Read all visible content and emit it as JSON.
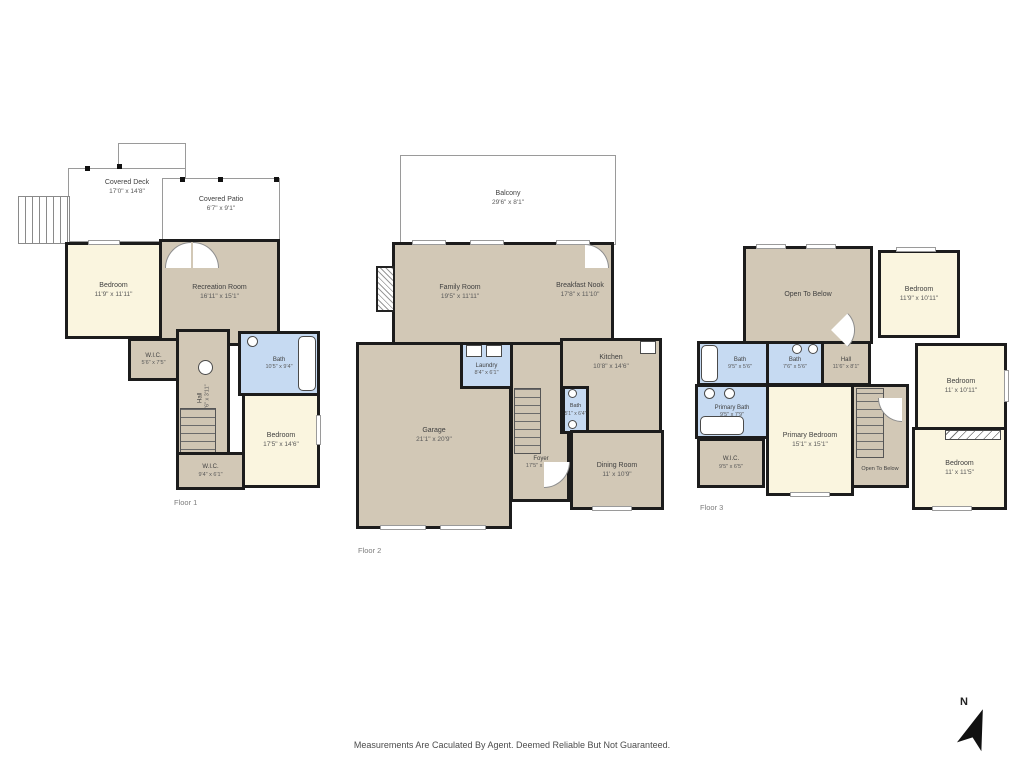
{
  "page": {
    "disclaimer": "Measurements Are Caculated By Agent. Deemed Reliable But Not Guaranteed.",
    "compass_label": "N"
  },
  "colors": {
    "wall": "#1c1c1c",
    "room_tan": "#d2c8b6",
    "room_cream": "#faf5df",
    "room_blue": "#c6daf2",
    "outdoor_outline": "#9a9a9a"
  },
  "floors": [
    {
      "label": "Floor 1",
      "rooms": [
        {
          "name": "Covered Deck",
          "dims": "17'0\" x 14'8\""
        },
        {
          "name": "Covered Patio",
          "dims": "6'7\" x 9'1\""
        },
        {
          "name": "Bedroom",
          "dims": "11'9\" x 11'11\""
        },
        {
          "name": "Recreation Room",
          "dims": "16'11\" x 15'1\""
        },
        {
          "name": "W.I.C.",
          "dims": "5'6\" x 7'5\""
        },
        {
          "name": "Bath",
          "dims": "10'5\" x 9'4\""
        },
        {
          "name": "Hall",
          "dims": "9'6\" x 3'11\""
        },
        {
          "name": "Bedroom",
          "dims": "17'5\" x 14'6\""
        },
        {
          "name": "W.I.C.",
          "dims": "9'4\" x 6'1\""
        }
      ]
    },
    {
      "label": "Floor 2",
      "rooms": [
        {
          "name": "Balcony",
          "dims": "29'6\" x 8'1\""
        },
        {
          "name": "Family Room",
          "dims": "19'5\" x 11'11\""
        },
        {
          "name": "Breakfast Nook",
          "dims": "17'8\" x 11'10\""
        },
        {
          "name": "Laundry",
          "dims": "8'4\" x 6'1\""
        },
        {
          "name": "Kitchen",
          "dims": "10'8\" x 14'6\""
        },
        {
          "name": "Bath",
          "dims": "5'1\" x 6'4\""
        },
        {
          "name": "Garage",
          "dims": "21'1\" x 20'9\""
        },
        {
          "name": "Foyer",
          "dims": "17'5\" x 14'6\""
        },
        {
          "name": "Dining Room",
          "dims": "11' x 10'9\""
        }
      ]
    },
    {
      "label": "Floor 3",
      "rooms": [
        {
          "name": "Open To Below",
          "dims": ""
        },
        {
          "name": "Bedroom",
          "dims": "11'9\" x 10'11\""
        },
        {
          "name": "Bath",
          "dims": "9'5\" x 5'6\""
        },
        {
          "name": "Bath",
          "dims": "7'6\" x 5'6\""
        },
        {
          "name": "Hall",
          "dims": "11'6\" x 8'1\""
        },
        {
          "name": "Bedroom",
          "dims": "11' x 10'11\""
        },
        {
          "name": "Primary Bath",
          "dims": "9'5\" x 7'9\""
        },
        {
          "name": "Primary Bedroom",
          "dims": "15'1\" x 15'1\""
        },
        {
          "name": "W.I.C.",
          "dims": "9'5\" x 6'5\""
        },
        {
          "name": "Open To Below",
          "dims": ""
        },
        {
          "name": "Bedroom",
          "dims": "11' x 11'5\""
        }
      ]
    }
  ]
}
